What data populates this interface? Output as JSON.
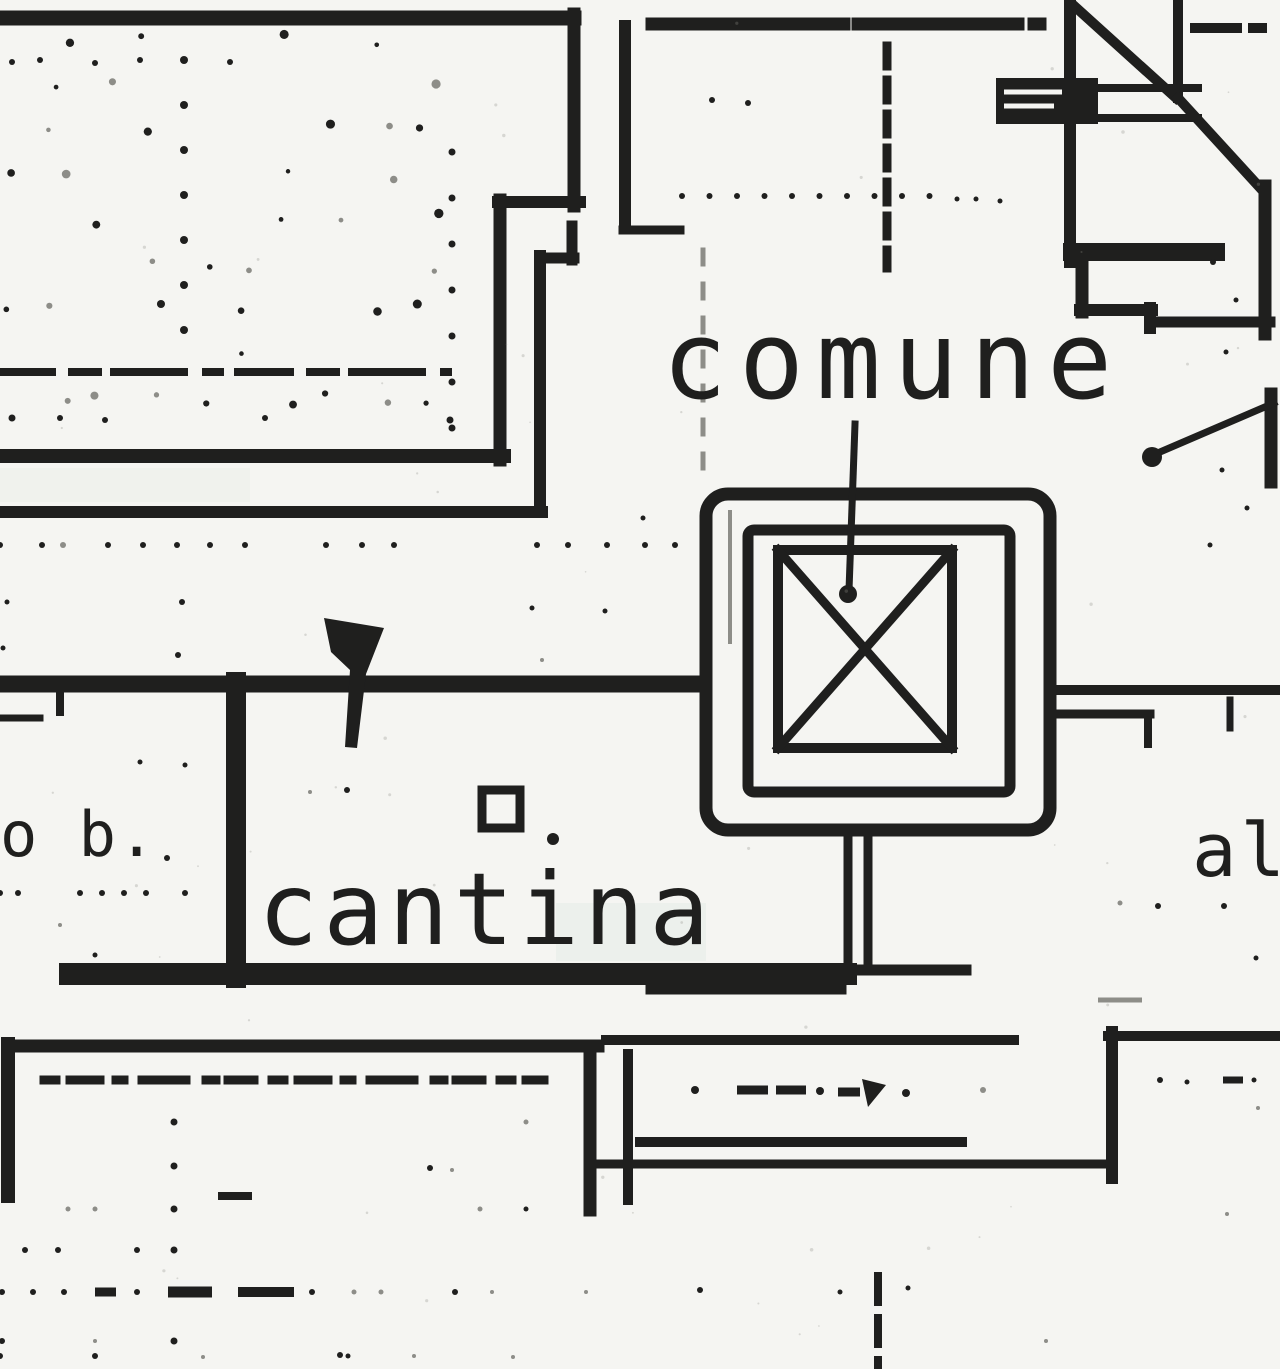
{
  "plan": {
    "labels": {
      "comune": "comune",
      "cantina": "cantina",
      "left_partial": "o b.",
      "right_partial": "al"
    },
    "symbols": {
      "elevator": "elevator-shaft-x-box",
      "stairs": "stair-run-diagonals",
      "door_marker": "solid-threshold-block"
    },
    "colors": {
      "ink": "#1f1f1e",
      "faint": "#8d8d88",
      "paper": "#f5f5f2"
    }
  }
}
